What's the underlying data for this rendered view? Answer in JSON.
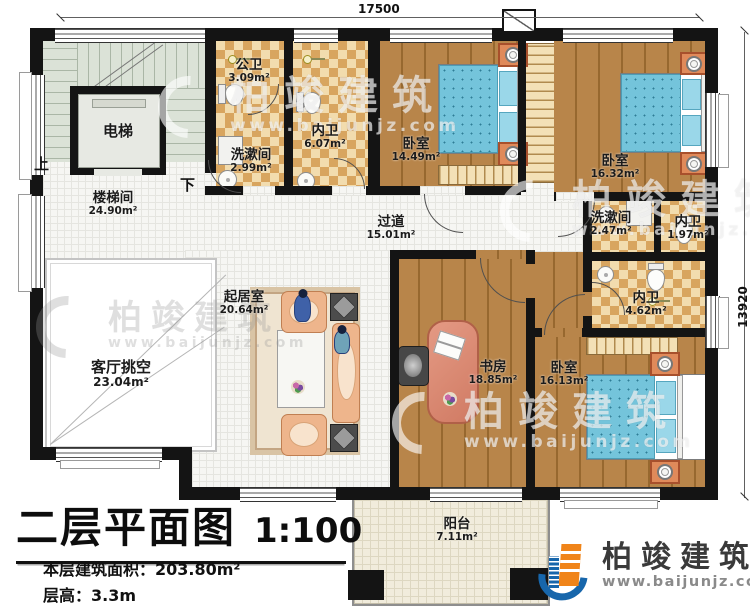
{
  "plan": {
    "dimensions": {
      "top_width": "17500",
      "right_height": "13920"
    },
    "stairs": {
      "up": "上",
      "down": "下"
    },
    "rooms": [
      {
        "id": "stair-hall",
        "name": "楼梯间",
        "area": "24.90m²"
      },
      {
        "id": "elevator",
        "name": "电梯",
        "area": ""
      },
      {
        "id": "public-bath",
        "name": "公卫",
        "area": "3.09m²"
      },
      {
        "id": "washroom-1",
        "name": "洗漱间",
        "area": "2.99m²"
      },
      {
        "id": "inner-bath-1",
        "name": "内卫",
        "area": "6.07m²"
      },
      {
        "id": "bedroom-1",
        "name": "卧室",
        "area": "14.49m²"
      },
      {
        "id": "bedroom-2",
        "name": "卧室",
        "area": "16.32m²"
      },
      {
        "id": "hallway",
        "name": "过道",
        "area": "15.01m²"
      },
      {
        "id": "washroom-2",
        "name": "洗漱间",
        "area": "2.47m²"
      },
      {
        "id": "inner-bath-2",
        "name": "内卫",
        "area": "1.97m²"
      },
      {
        "id": "inner-bath-3",
        "name": "内卫",
        "area": "4.62m²"
      },
      {
        "id": "living-room",
        "name": "起居室",
        "area": "20.64m²"
      },
      {
        "id": "void",
        "name": "客厅挑空",
        "area": "23.04m²"
      },
      {
        "id": "study",
        "name": "书房",
        "area": "18.85m²"
      },
      {
        "id": "bedroom-3",
        "name": "卧室",
        "area": "16.13m²"
      },
      {
        "id": "balcony",
        "name": "阳台",
        "area": "7.11m²"
      }
    ]
  },
  "title_block": {
    "title": "二层平面图",
    "scale": "1:100",
    "area_label": "本层建筑面积：",
    "area_value": "203.80m²",
    "height_label": "层高：",
    "height_value": "3.3m"
  },
  "brand": {
    "name": "柏竣建筑",
    "website": "www.baijunjz.com"
  },
  "colors": {
    "wall": "#141414",
    "wood": "#ab7a41",
    "tile_dark": "#d8a55f",
    "bed_blue": "#74c4db",
    "logo_blue": "#1766ab",
    "logo_orange": "#f08419"
  }
}
